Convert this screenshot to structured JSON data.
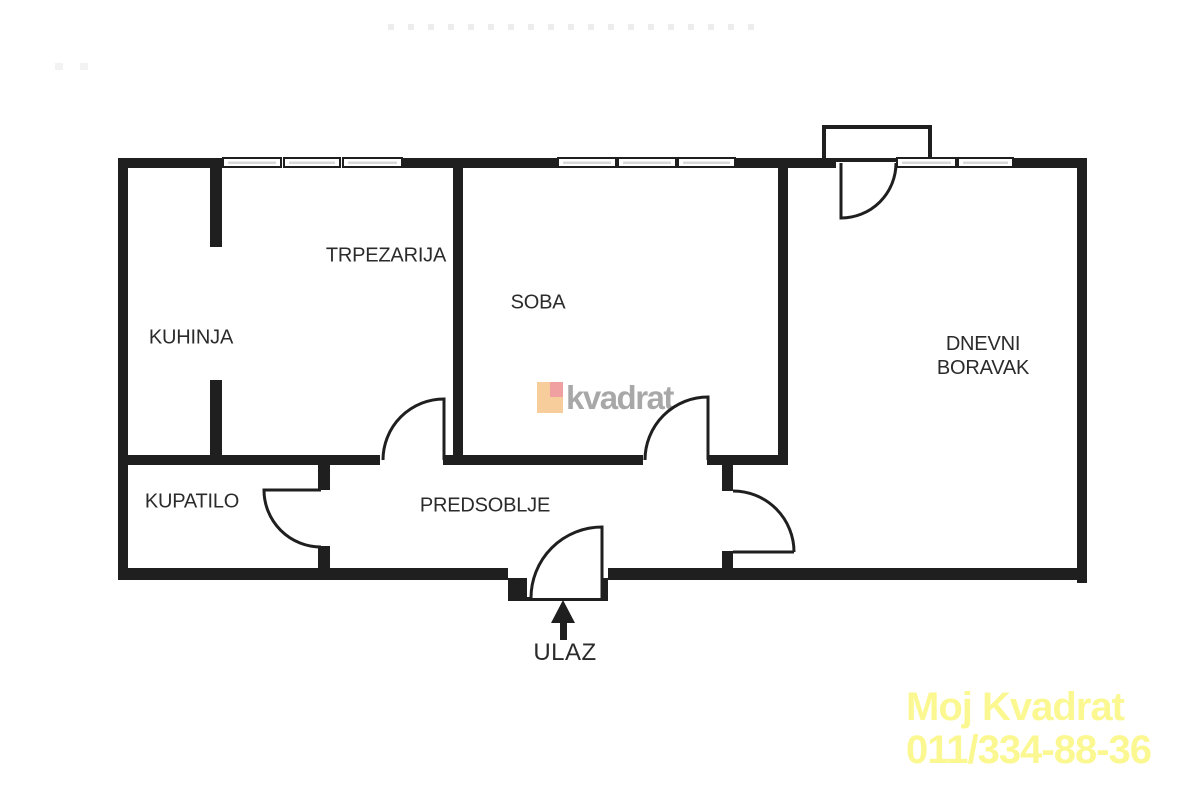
{
  "plan_title": "Apartment floor plan",
  "rooms": [
    {
      "id": "kuhinja",
      "label": "KUHINJA"
    },
    {
      "id": "trpezarija",
      "label": "TRPEZARIJA"
    },
    {
      "id": "soba",
      "label": "SOBA"
    },
    {
      "id": "dnevni-boravak",
      "label": "DNEVNI BORAVAK"
    },
    {
      "id": "kupatilo",
      "label": "KUPATILO"
    },
    {
      "id": "predsoblje",
      "label": "PREDSOBLJE"
    }
  ],
  "entrance": {
    "label": "ULAZ"
  },
  "watermarks": {
    "center": {
      "text": "kvadrat"
    },
    "corner": {
      "line1": "Moj Kvadrat",
      "line2": "011/334-88-36"
    }
  },
  "colors": {
    "wall": "#1f1f1f",
    "window_hatch": "#d8d8d8",
    "label_text": "#2b2b2b",
    "logo_square_orange": "#f8cd9c",
    "logo_square_pink": "#f1a0a2",
    "watermark_gray": "#a8a8a8",
    "watermark_yellow": "#fbf892",
    "faint_dots": "#ededed"
  }
}
